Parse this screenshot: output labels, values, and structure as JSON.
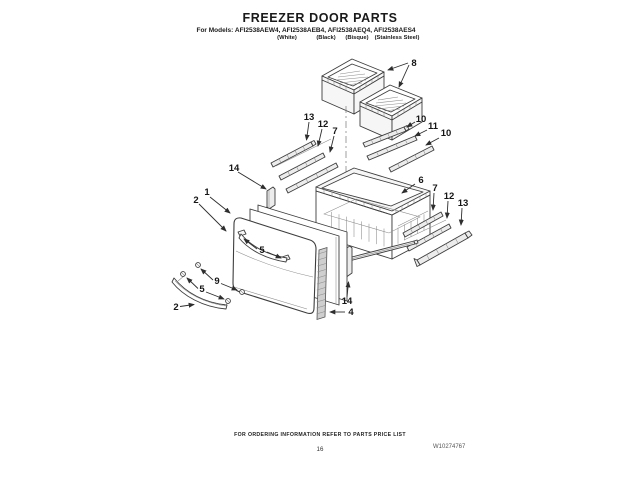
{
  "page": {
    "title": "FREEZER DOOR PARTS",
    "models_label": "For Models: AFI2538AEW4, AFI2538AEB4, AFI2538AEQ4, AFI2538AES4",
    "finishes": [
      "(White)",
      "(Black)",
      "(Bisque)",
      "(Stainless Steel)"
    ],
    "footer_note": "FOR ORDERING INFORMATION REFER TO PARTS PRICE LIST",
    "page_number": "16",
    "document_number": "W10274767"
  },
  "diagram": {
    "description": "Exploded view line drawing of freezer door parts with numbered callouts",
    "ink_color": "#3d3d3d",
    "callouts": [
      {
        "id": "callout-8",
        "label": "8"
      },
      {
        "id": "callout-13L",
        "label": "13"
      },
      {
        "id": "callout-12L",
        "label": "12"
      },
      {
        "id": "callout-7L",
        "label": "7"
      },
      {
        "id": "callout-10a",
        "label": "10"
      },
      {
        "id": "callout-11",
        "label": "11"
      },
      {
        "id": "callout-10b",
        "label": "10"
      },
      {
        "id": "callout-14L",
        "label": "14"
      },
      {
        "id": "callout-1",
        "label": "1"
      },
      {
        "id": "callout-2a",
        "label": "2"
      },
      {
        "id": "callout-6",
        "label": "6"
      },
      {
        "id": "callout-7R",
        "label": "7"
      },
      {
        "id": "callout-12R",
        "label": "12"
      },
      {
        "id": "callout-13R",
        "label": "13"
      },
      {
        "id": "callout-5a",
        "label": "5"
      },
      {
        "id": "callout-9",
        "label": "9"
      },
      {
        "id": "callout-5b",
        "label": "5"
      },
      {
        "id": "callout-2b",
        "label": "2"
      },
      {
        "id": "callout-14b",
        "label": "14"
      },
      {
        "id": "callout-4",
        "label": "4"
      }
    ]
  }
}
